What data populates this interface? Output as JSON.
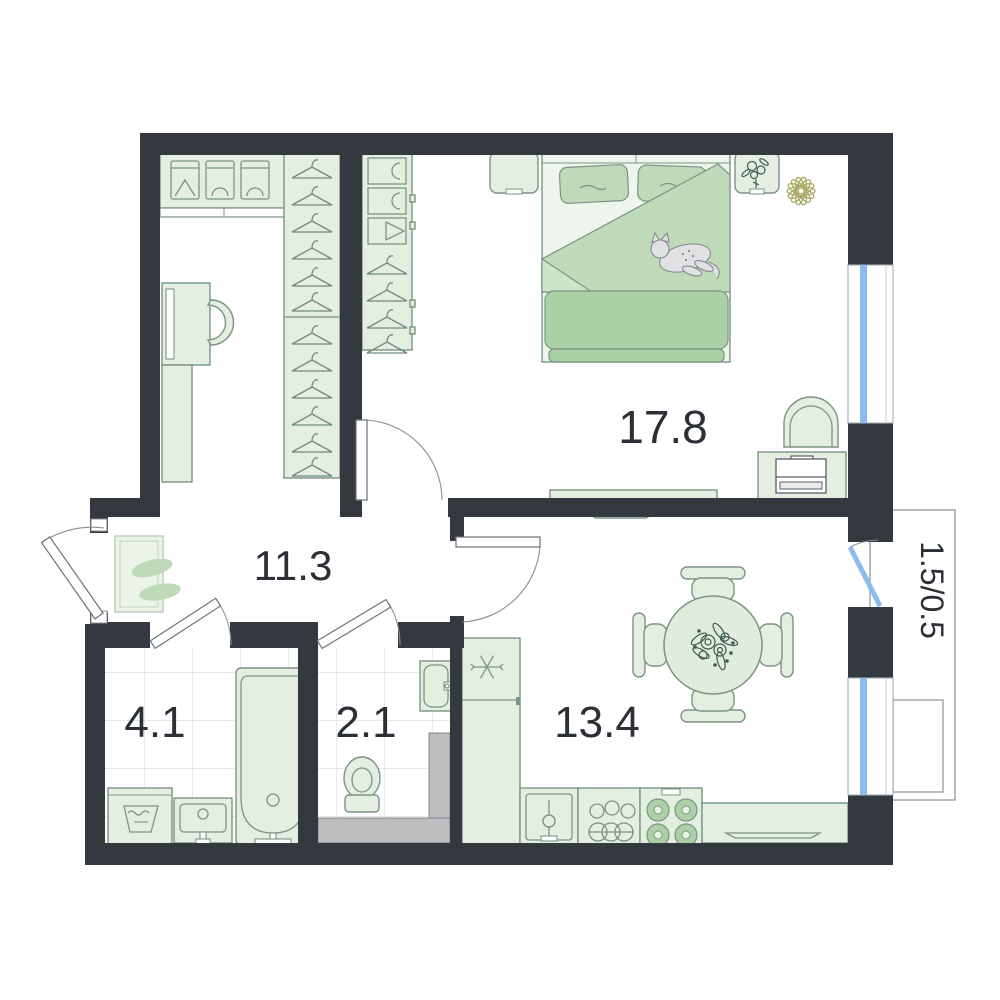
{
  "title": "One-bedroom apartment floor plan",
  "rooms": {
    "bedroom": {
      "name": "bedroom",
      "area": "17.8"
    },
    "hallway": {
      "name": "hallway",
      "area": "11.3"
    },
    "bathroom": {
      "name": "bathroom",
      "area": "4.1"
    },
    "toilet": {
      "name": "toilet",
      "area": "2.1"
    },
    "kitchen": {
      "name": "kitchen-living",
      "area": "13.4"
    },
    "balcony": {
      "name": "balcony",
      "area": "1.5/0.5"
    }
  },
  "colors": {
    "wall": "#34383f",
    "furniture_fill": "#e4efe1",
    "furniture_stroke": "#7b9484",
    "accent_green": "#bedab8",
    "window_glass": "#8cbbee",
    "shaft_gray": "#bcbec0",
    "plant_olive": "#a9a965",
    "label_ink": "#2b2f36"
  }
}
